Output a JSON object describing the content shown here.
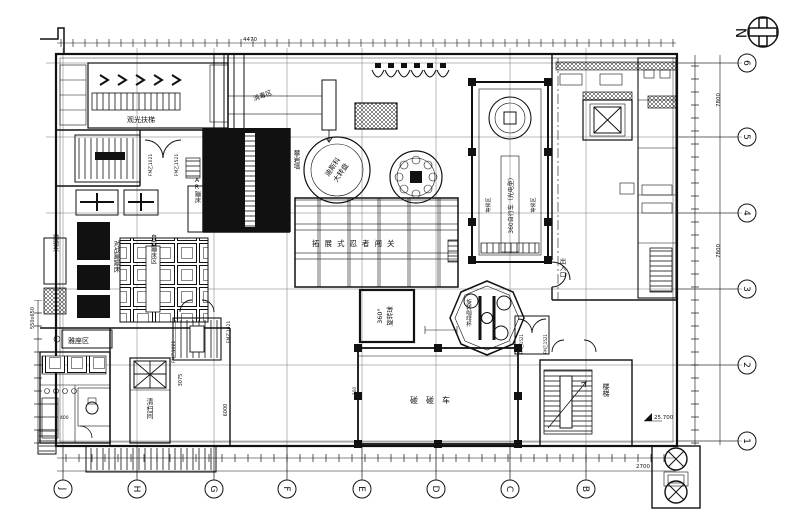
{
  "drawing": {
    "north_label": "N",
    "grid_axes": {
      "right": [
        "6",
        "5",
        "4",
        "3",
        "2",
        "1"
      ],
      "bottom": [
        "J",
        "H",
        "G",
        "F",
        "E",
        "D",
        "C",
        "B"
      ]
    },
    "labels": {
      "escalator": "观光扶梯",
      "disinfection": "消毒区",
      "climbing_wall": "攀岩墙",
      "ar_trampoline": "AR蹦床",
      "battle_trampoline": "对战蹦蹦床",
      "free_trampoline": "自由蹦床区",
      "paopao": "抛抛乐",
      "seating": "雅座区",
      "disco_line1": "迪斯科",
      "disco_line2": "大转盘",
      "ninja": "拓展式忍者闯关",
      "bike360": "360自行车（光电型）",
      "waiting": "等候区",
      "entrance": "出入口",
      "coffee_cups": "旋转咖啡杯",
      "ball360_line1": "360°",
      "ball360_line2": "旋转球",
      "bumper_cars": "碰碰车",
      "stairs": "楼梯",
      "cleaning_room": "清扫间"
    },
    "door_tags": {
      "fm1021": "FM乙1021",
      "fm1521": "FM乙1521"
    },
    "dimensions": {
      "top": "4470",
      "right_bay": "7800",
      "bottom_right": "2700",
      "elevation": "25.700",
      "d3075": "3075",
      "d6000": "6000",
      "d400": "400",
      "d100": "100",
      "hydrant": "550x650"
    }
  }
}
